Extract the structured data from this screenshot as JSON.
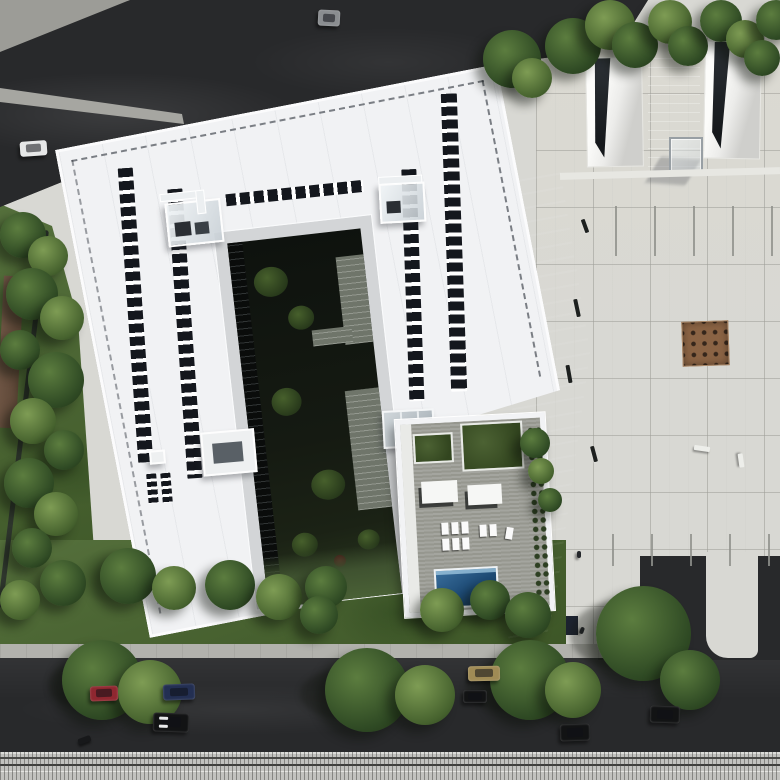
{
  "meta": {
    "type": "aerial-architectural-render",
    "description": "Top-down 3D rendering of a white U-shaped building with rooftop solar panel strips, a sunken landscaped courtyard, and a rooftop pool terrace, bordered by asphalt roads, lawns with trees, a tiled public plaza and a tram line along the bottom edge",
    "visible_text": "none"
  },
  "palette": {
    "plaza": "#d8d8d3",
    "road": "#28292b",
    "sidewalk": "#b2b2ad",
    "rail": "#c2c2bf",
    "lawnA": "#55703c",
    "lawnB": "#3c5526",
    "roof": "#f1f2f4",
    "parapet": "#fbfbfc",
    "panel": "#14171d",
    "grove": "#8a6344",
    "treeA": "#5c7d3f",
    "treeB": "#2f4a24",
    "carRed": "#8f2730",
    "carBlue": "#232f52",
    "carBlack": "#121314",
    "carWhite": "#e6e7e7",
    "carTan": "#a08b55",
    "truckGray": "#8a8d90"
  },
  "building": {
    "label": "white U-shaped office building, aerial view, rotated on site",
    "roof": "white roof with dashed parapet trim and photovoltaic panel strips",
    "solar_panels": {
      "strips": 6,
      "approx_count": 140
    },
    "rooftop_structures": [
      "glass elevator enclosure (left wing)",
      "glass elevator enclosure (right wing)",
      "white plant-room box (left wing)",
      "glass skylight (near terrace)"
    ],
    "courtyard": {
      "label": "sunken landscaped courtyard",
      "features": [
        "dark paving",
        "shrub clusters",
        "stone paths",
        "glazed inner facade"
      ]
    },
    "terrace": {
      "label": "rooftop pool terrace",
      "features": [
        "wood deck",
        "two green planters",
        "cabanas",
        "sun loungers",
        "swimming pool",
        "edge planting"
      ],
      "pool_label": "swimming pool"
    }
  },
  "plaza": {
    "label": "tiled public plaza",
    "features": [
      "stone tile grid",
      "two sunken light wells",
      "access ramp",
      "glass cube pavilion",
      "square tree-grove planter",
      "parking stall markings",
      "benches",
      "street lamp",
      "pedestrians"
    ]
  },
  "roads": {
    "top_road": "dark asphalt road (upper left)",
    "bottom_road": "dark asphalt street with parked vehicles and street trees",
    "tramway": "tram / rail tracks along bottom edge",
    "sidewalk": "light concrete sidewalk"
  },
  "landscape": {
    "left_lawn": "lawn strip with dense trees and brown mulch bed",
    "bottom_lawn": "lawn with trees between building and street",
    "street_trees": "large canopies overhanging the bottom road"
  },
  "vehicles": [
    {
      "id": "white-car-top",
      "label": "white car on upper road",
      "color": "#e6e7e7"
    },
    {
      "id": "gray-truck",
      "label": "gray truck on upper road",
      "color": "#8a8d90"
    },
    {
      "id": "red-car",
      "label": "red parked car",
      "color": "#8f2730"
    },
    {
      "id": "blue-car",
      "label": "dark blue parked car",
      "color": "#232f52"
    },
    {
      "id": "black-suv",
      "label": "black car with light roof rails",
      "color": "#121314"
    },
    {
      "id": "motorcycle",
      "label": "parked motorcycle",
      "color": "#17181a"
    },
    {
      "id": "tan-car",
      "label": "tan parked car",
      "color": "#a08b55"
    },
    {
      "id": "black-hatch",
      "label": "small black car",
      "color": "#141517"
    },
    {
      "id": "black-car-right",
      "label": "black car near plaza driveway",
      "color": "#101112"
    },
    {
      "id": "black-car-far",
      "label": "black car lower right",
      "color": "#0c0d0e"
    }
  ],
  "site_furniture": {
    "benches_dark": 4,
    "benches_white": 2,
    "street_lamps": 1,
    "people": 3,
    "glass_cube": "glass cube pavilion on plaza",
    "light_wells": "two sunken light wells with white splayed walls",
    "tree_grove": "square planter with 16 small trees in a grid"
  }
}
